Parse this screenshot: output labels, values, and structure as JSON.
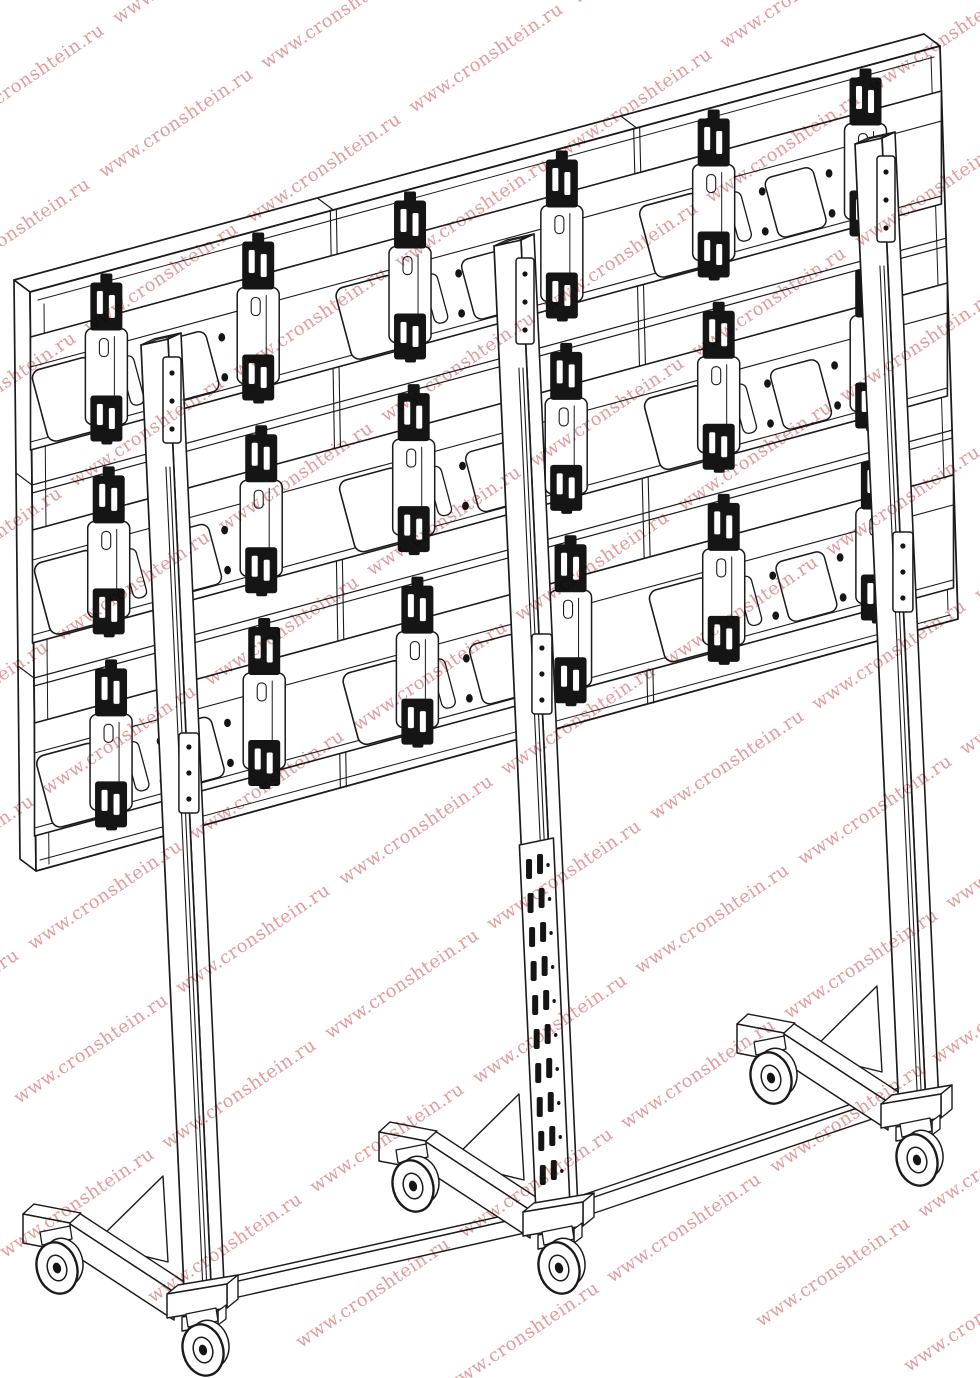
{
  "canvas": {
    "width": 980,
    "height": 1378,
    "background": "#ffffff",
    "line_color": "#1b1b1b",
    "dark_fill": "#151515"
  },
  "watermark": {
    "text": "www.cronshtein.ru",
    "color": "#dd8a8c",
    "rotation_deg": -34,
    "font_size_px": 18,
    "opacity": 0.85
  },
  "illustration": {
    "subject": "mobile-floor-stand-for-3x3-video-wall-rear-isometric-view",
    "panel_rows": 3,
    "panel_columns": 3,
    "upright_columns": 3,
    "base_legs": 3,
    "casters": 6,
    "parts": [
      "video-wall-panel",
      "panel-top-face",
      "panel-side-face",
      "panel-mounting-rail",
      "vesa-bracket-strip",
      "bracket-hook",
      "rail-cutout",
      "screw-hole",
      "upright-column",
      "column-cap",
      "clamp-plate",
      "telescopic-inner-tube",
      "perforated-strut",
      "connecting-rail",
      "front-leg",
      "gusset-plate",
      "base-block",
      "swivel-caster"
    ]
  }
}
